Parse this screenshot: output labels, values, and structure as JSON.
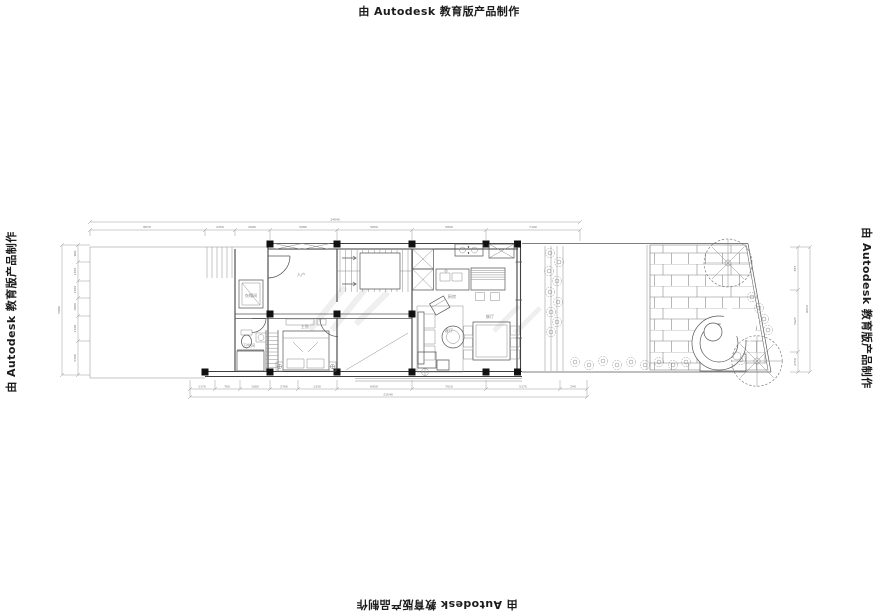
{
  "watermarks": {
    "top": "由 Autodesk 教育版产品制作",
    "left": "由 Autodesk 教育版产品制作",
    "right": "由 Autodesk 教育版产品制作",
    "bottom": "由 Autodesk 教育版产品制作"
  },
  "rooms": {
    "entry": "入户",
    "cloak": "衣帽间",
    "bath": "卫生间",
    "bedroom": "主卧",
    "kitchen": "厨房",
    "dining": "餐厅",
    "living": "客厅"
  },
  "dims": {
    "top": {
      "overall": "24940",
      "segs": [
        "8670",
        "2250",
        "2690",
        "5080",
        "5650",
        "5650",
        "7100"
      ]
    },
    "bottom": {
      "overall": "21540",
      "segs": [
        "1175",
        "760",
        "1060",
        "2760",
        "1330",
        "6950",
        "7010",
        "5175",
        "240"
      ]
    },
    "left": {
      "overall": "5980",
      "segs": [
        "900",
        "1650",
        "1650",
        "1800",
        "2100",
        "3300"
      ]
    },
    "right": {
      "overall": "8650",
      "segs": [
        "875",
        "5025",
        "2750"
      ]
    }
  },
  "colors": {
    "wall": "#3f3f3f",
    "medium": "#565656",
    "thin": "#8b8b8b",
    "dimension": "#9a9a9a",
    "column": "#111111",
    "watermark_text": "#1c1c1c",
    "background": "#ffffff"
  }
}
